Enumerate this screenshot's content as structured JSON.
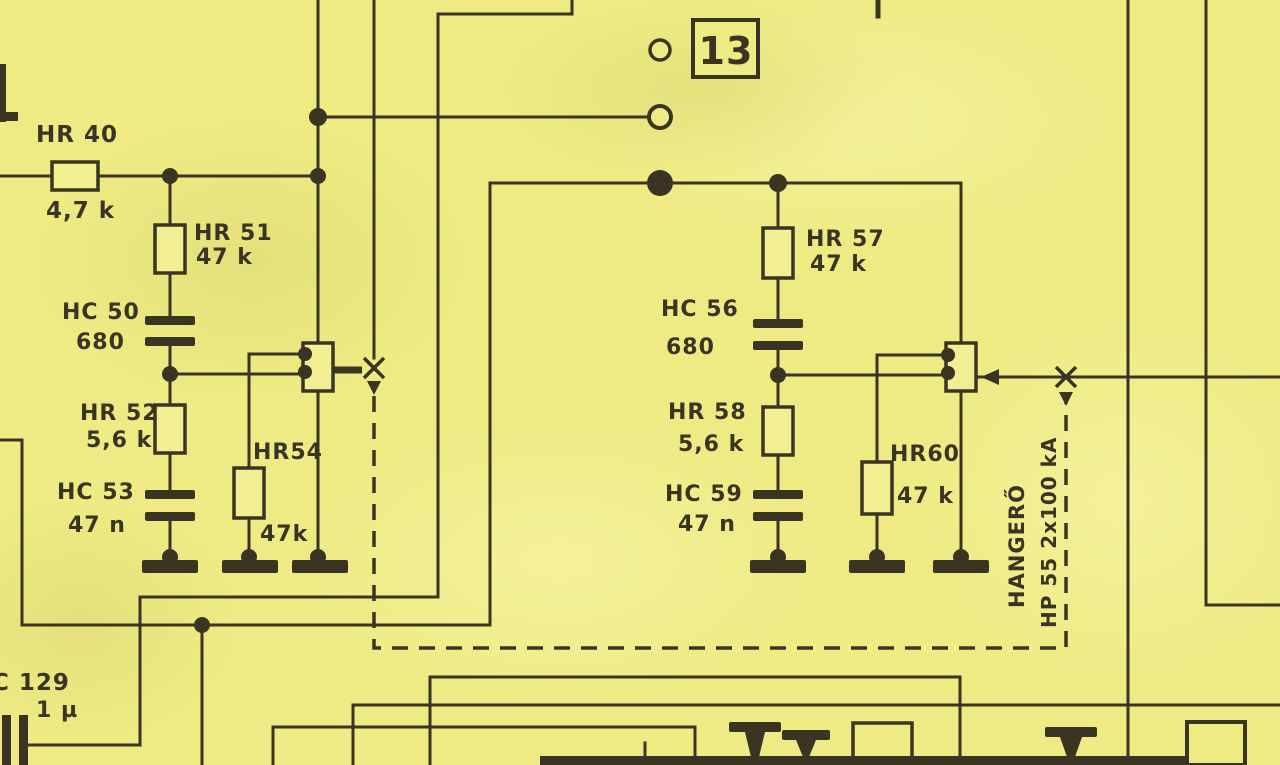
{
  "colors": {
    "paper": "#eeeb85",
    "ink": "#3a3522"
  },
  "terminal_box": {
    "label": "13"
  },
  "left_circuit": {
    "hr40": {
      "ref": "HR 40",
      "value": "4,7 k"
    },
    "hr51": {
      "ref": "HR 51",
      "value": "47 k"
    },
    "hc50": {
      "ref": "HC 50",
      "value": "680"
    },
    "hr52": {
      "ref": "HR 52",
      "value": "5,6 k"
    },
    "hc53": {
      "ref": "HC 53",
      "value": "47 n"
    },
    "hr54": {
      "ref": "HR54",
      "value": "47k"
    }
  },
  "right_circuit": {
    "hr57": {
      "ref": "HR 57",
      "value": "47 k"
    },
    "hc56": {
      "ref": "HC 56",
      "value": "680"
    },
    "hr58": {
      "ref": "HR 58",
      "value": "5,6 k"
    },
    "hc59": {
      "ref": "HC 59",
      "value": "47 n"
    },
    "hr60": {
      "ref": "HR60",
      "value": "47 k"
    }
  },
  "volume_pot": {
    "name": "HANGERŐ",
    "type": "HP 55 2x100 kA"
  },
  "c129": {
    "ref": "C 129",
    "value": "1 µ"
  }
}
